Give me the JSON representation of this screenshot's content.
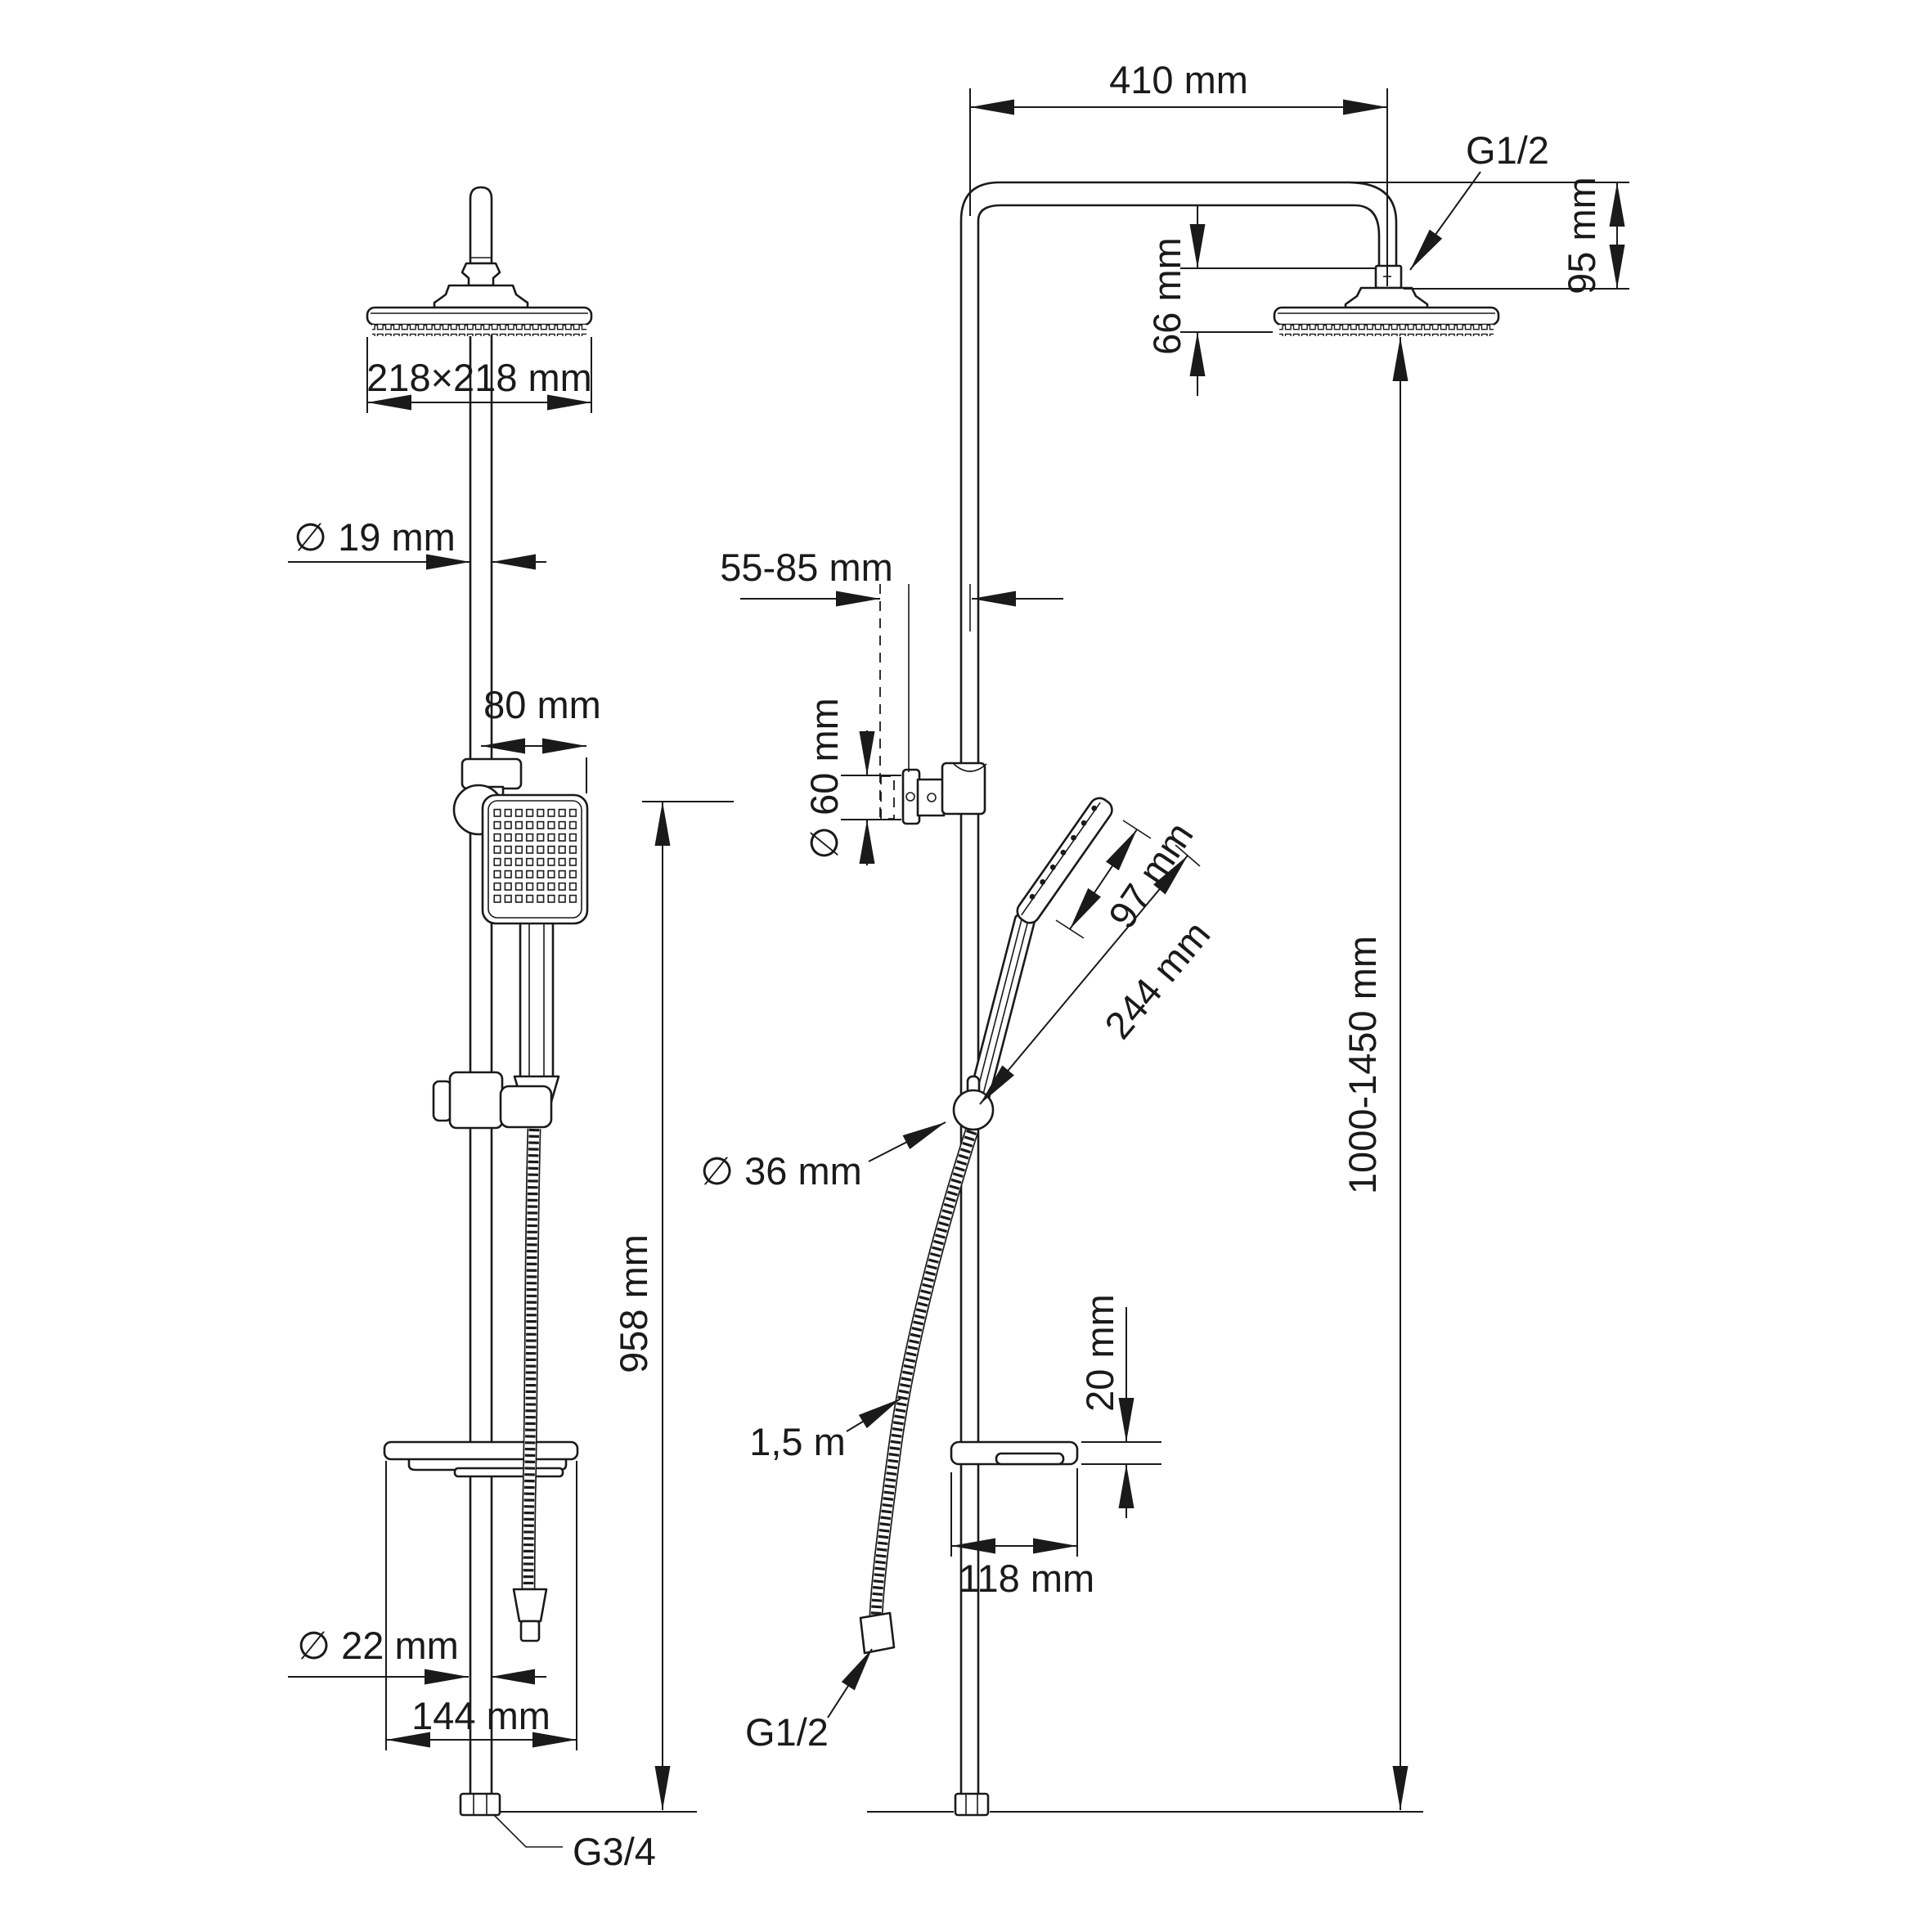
{
  "title": "Shower column technical dimension drawing",
  "colors": {
    "line": "#1a1a1a",
    "background": "#ffffff"
  },
  "drawing": {
    "front_view": {
      "head_size": "218×218 mm",
      "riser_diameter": "∅ 19 mm",
      "handshower_offset": "80 mm",
      "rail_length": "958 mm",
      "lower_riser_diameter": "∅ 22 mm",
      "shelf_width": "144 mm",
      "inlet_thread": "G3/4"
    },
    "side_view": {
      "arm_reach": "410 mm",
      "overhead_thread": "G1/2",
      "arm_drop": "95 mm",
      "head_depth": "66 mm",
      "wall_clearance": "55-85 mm",
      "bracket_flange_diameter": "∅ 60 mm",
      "handshower_head_length": "97 mm",
      "handshower_length": "244 mm",
      "holder_diameter": "∅ 36 mm",
      "installation_height": "1000-1450 mm",
      "shelf_thickness": "20 mm",
      "hose_length": "1,5 m",
      "shelf_depth": "118 mm",
      "hose_thread": "G1/2"
    }
  }
}
